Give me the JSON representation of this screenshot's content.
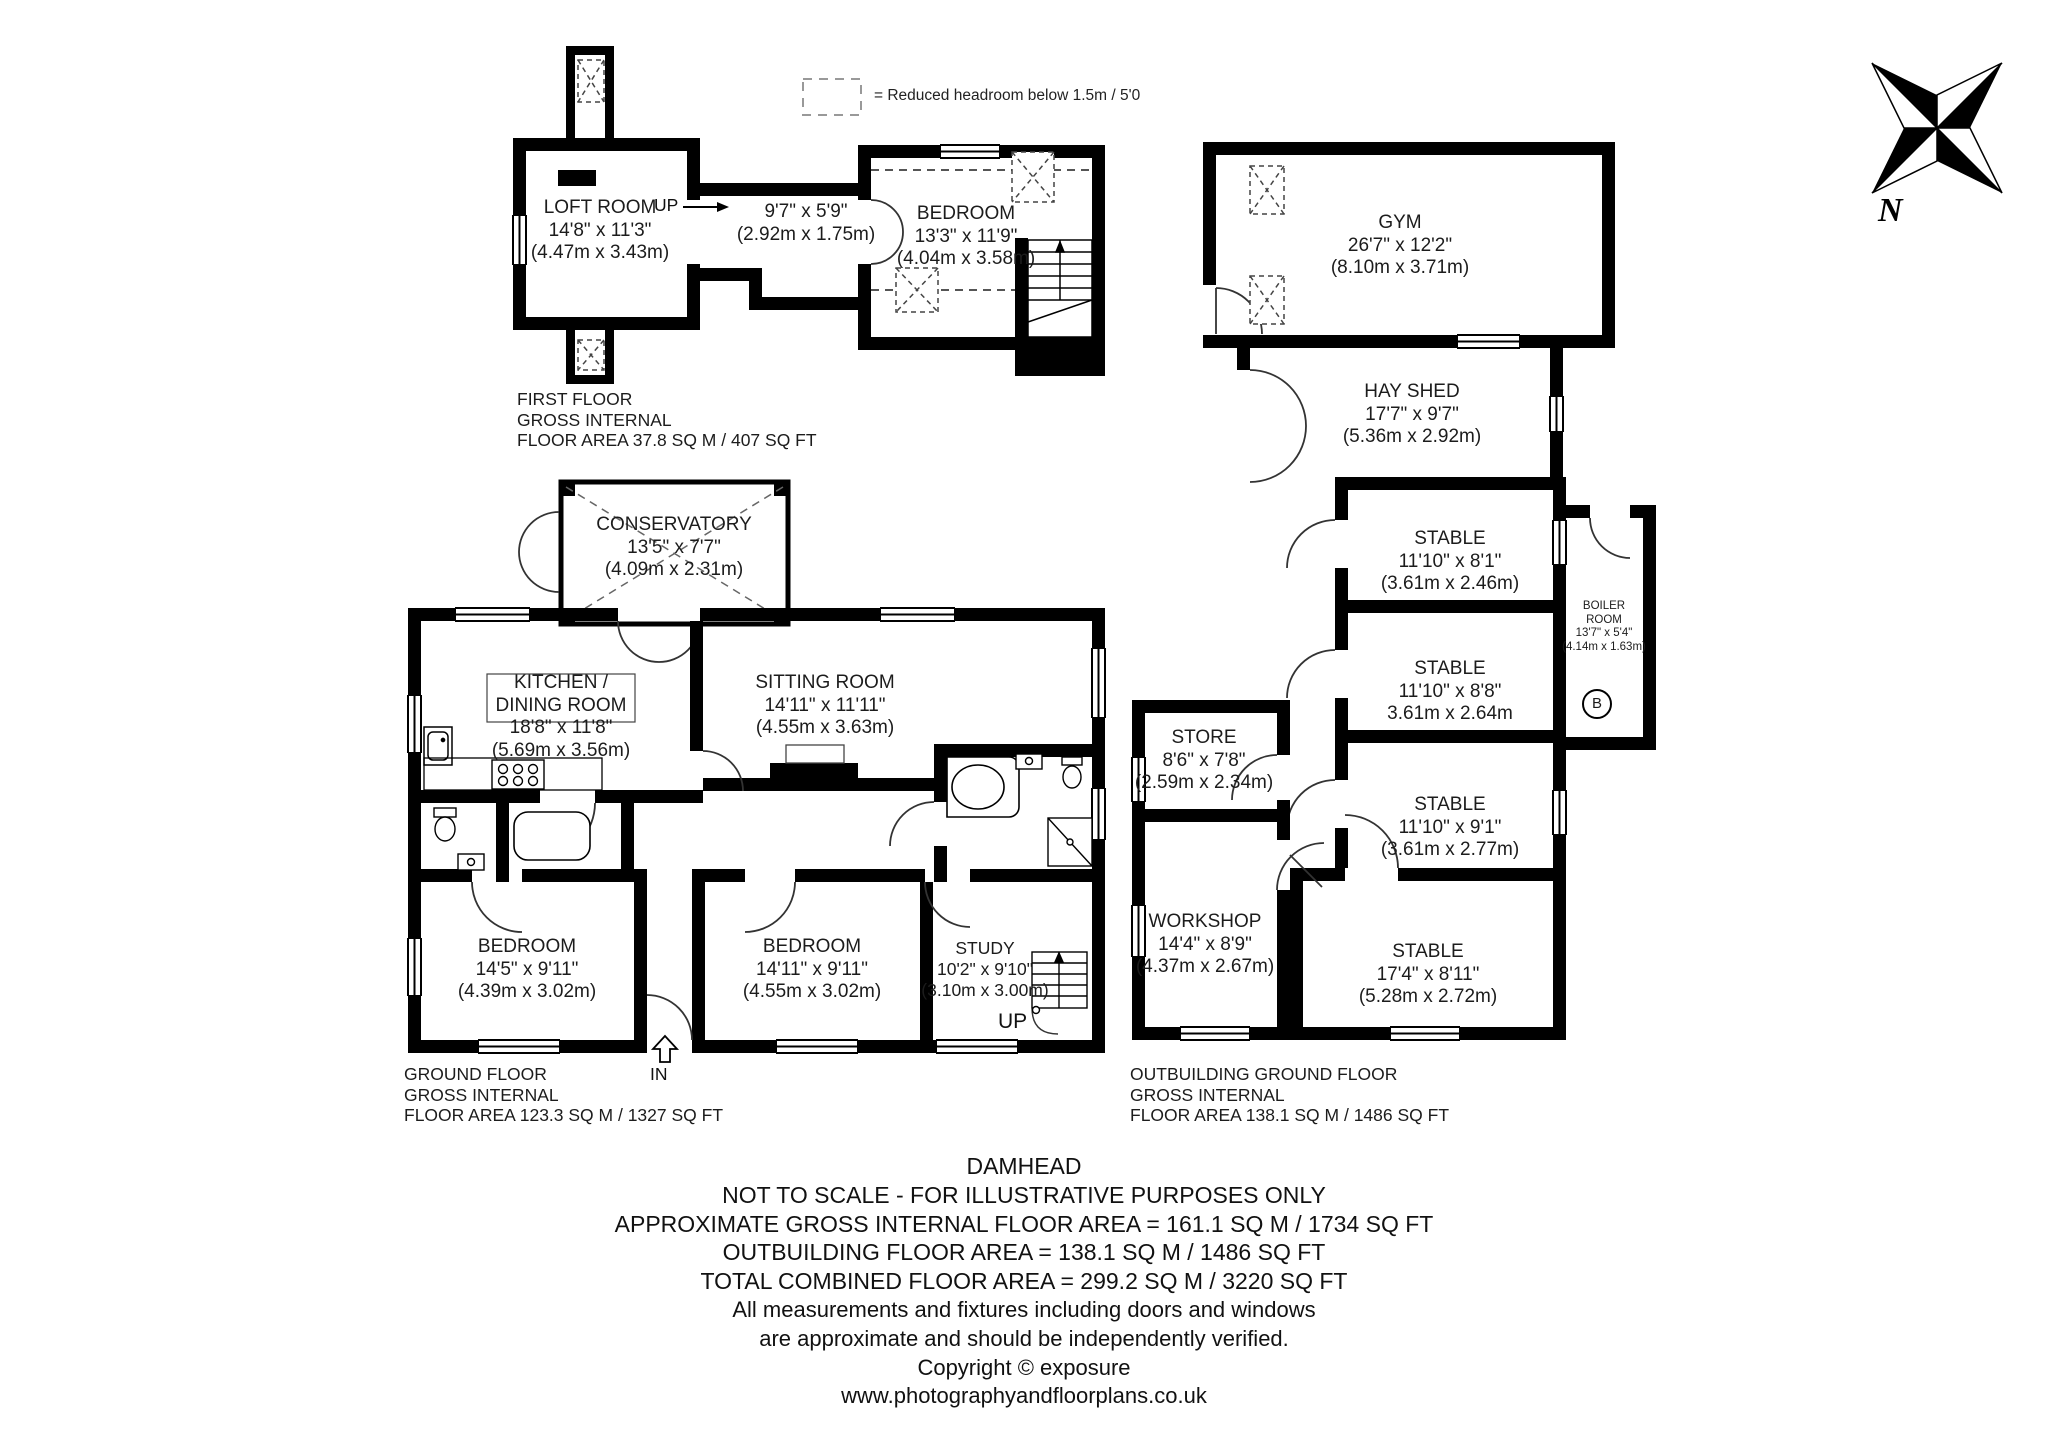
{
  "legend": {
    "label": "= Reduced headroom below 1.5m / 5'0"
  },
  "compass": {
    "n": "N"
  },
  "first_floor": {
    "loft": {
      "name": "LOFT ROOM",
      "ft": "14'8\" x 11'3\"",
      "m": "(4.47m x 3.43m)"
    },
    "loft_up": "UP",
    "landing": {
      "ft": "9'7\" x 5'9\"",
      "m": "(2.92m x 1.75m)"
    },
    "bedroom": {
      "name": "BEDROOM",
      "ft": "13'3\" x 11'9\"",
      "m": "(4.04m x 3.58m)"
    },
    "area": {
      "l1": "FIRST FLOOR",
      "l2": "GROSS INTERNAL",
      "l3": "FLOOR AREA 37.8 SQ M / 407 SQ FT"
    }
  },
  "ground_floor": {
    "conservatory": {
      "name": "CONSERVATORY",
      "ft": "13'5\" x 7'7\"",
      "m": "(4.09m x 2.31m)"
    },
    "kitchen": {
      "name1": "KITCHEN /",
      "name2": "DINING ROOM",
      "ft": "18'8\" x 11'8\"",
      "m": "(5.69m x 3.56m)"
    },
    "sitting": {
      "name": "SITTING ROOM",
      "ft": "14'11\" x 11'11\"",
      "m": "(4.55m x 3.63m)"
    },
    "bedroom1": {
      "name": "BEDROOM",
      "ft": "14'5\" x 9'11\"",
      "m": "(4.39m x 3.02m)"
    },
    "bedroom2": {
      "name": "BEDROOM",
      "ft": "14'11\" x 9'11\"",
      "m": "(4.55m x 3.02m)"
    },
    "study": {
      "name": "STUDY",
      "ft": "10'2\" x 9'10\"",
      "m": "(3.10m x 3.00m)"
    },
    "study_up": "UP",
    "in_label": "IN",
    "area": {
      "l1": "GROUND FLOOR",
      "l2": "GROSS INTERNAL",
      "l3": "FLOOR AREA 123.3 SQ M / 1327 SQ FT"
    }
  },
  "outbuilding": {
    "gym": {
      "name": "GYM",
      "ft": "26'7\" x 12'2\"",
      "m": "(8.10m x 3.71m)"
    },
    "hay_shed": {
      "name": "HAY SHED",
      "ft": "17'7\" x 9'7\"",
      "m": "(5.36m x 2.92m)"
    },
    "stable1": {
      "name": "STABLE",
      "ft": "11'10\" x 8'1\"",
      "m": "(3.61m x 2.46m)"
    },
    "stable2": {
      "name": "STABLE",
      "ft": "11'10\" x 8'8\"",
      "m": "3.61m x 2.64m"
    },
    "stable3": {
      "name": "STABLE",
      "ft": "11'10\" x 9'1\"",
      "m": "(3.61m x 2.77m)"
    },
    "stable4": {
      "name": "STABLE",
      "ft": "17'4\" x 8'11\"",
      "m": "(5.28m x 2.72m)"
    },
    "boiler": {
      "name1": "BOILER",
      "name2": "ROOM",
      "ft": "13'7\" x 5'4\"",
      "m": "(4.14m x 1.63m)",
      "badge": "B"
    },
    "store": {
      "name": "STORE",
      "ft": "8'6\" x 7'8\"",
      "m": "(2.59m x 2.34m)"
    },
    "workshop": {
      "name": "WORKSHOP",
      "ft": "14'4\" x 8'9\"",
      "m": "(4.37m x 2.67m)"
    },
    "area": {
      "l1": "OUTBUILDING GROUND FLOOR",
      "l2": "GROSS INTERNAL",
      "l3": "FLOOR AREA 138.1 SQ M / 1486 SQ FT"
    }
  },
  "footer": {
    "lines": [
      "DAMHEAD",
      "NOT TO SCALE - FOR ILLUSTRATIVE PURPOSES ONLY",
      "APPROXIMATE GROSS INTERNAL FLOOR AREA = 161.1 SQ M / 1734 SQ FT",
      "OUTBUILDING FLOOR AREA = 138.1 SQ M / 1486 SQ FT",
      "TOTAL COMBINED FLOOR AREA = 299.2 SQ M / 3220 SQ FT",
      "All measurements and fixtures including doors and windows",
      "are approximate and should be independently verified.",
      "Copyright ©  exposure",
      "www.photographyandfloorplans.co.uk"
    ]
  }
}
